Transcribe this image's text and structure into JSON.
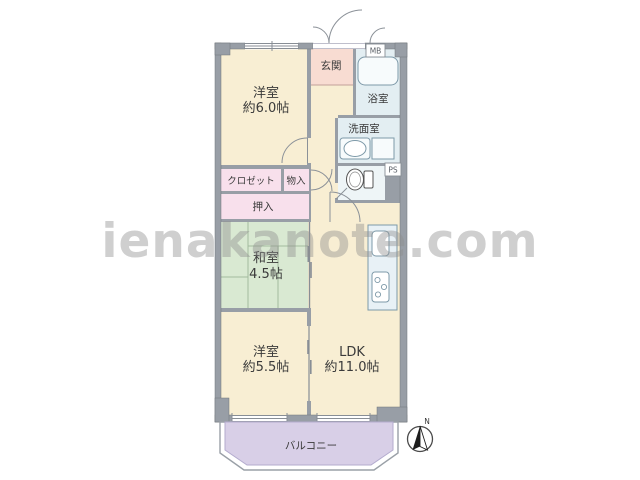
{
  "watermark": "ienakanote.com",
  "compass": {
    "north_label": "N"
  },
  "rooms": {
    "western_room_6": {
      "name": "洋室",
      "size": "約6.0帖"
    },
    "entrance": {
      "label": "玄関"
    },
    "bathroom": {
      "label": "浴室"
    },
    "washroom": {
      "label": "洗面室"
    },
    "meter_box": {
      "label": "MB"
    },
    "pipe_space": {
      "label": "PS"
    },
    "closet": {
      "label": "クロゼット"
    },
    "storage": {
      "label": "物入"
    },
    "oshiire": {
      "label": "押入"
    },
    "japanese_room": {
      "name": "和室",
      "size": "4.5帖"
    },
    "western_room_55": {
      "name": "洋室",
      "size": "約5.5帖"
    },
    "ldk": {
      "name": "LDK",
      "size": "約11.0帖"
    },
    "balcony": {
      "label": "バルコニー"
    }
  },
  "colors": {
    "wall_gray": "#989ea6",
    "floor_cream": "#f8eed3",
    "entrance_pink": "#f8dcd2",
    "closet_pink": "#f8e0ec",
    "tatami_green": "#d9e9d2",
    "wet_area_blue": "#e3eef2",
    "balcony_purple": "#d8cfe7",
    "background": "#ffffff"
  }
}
